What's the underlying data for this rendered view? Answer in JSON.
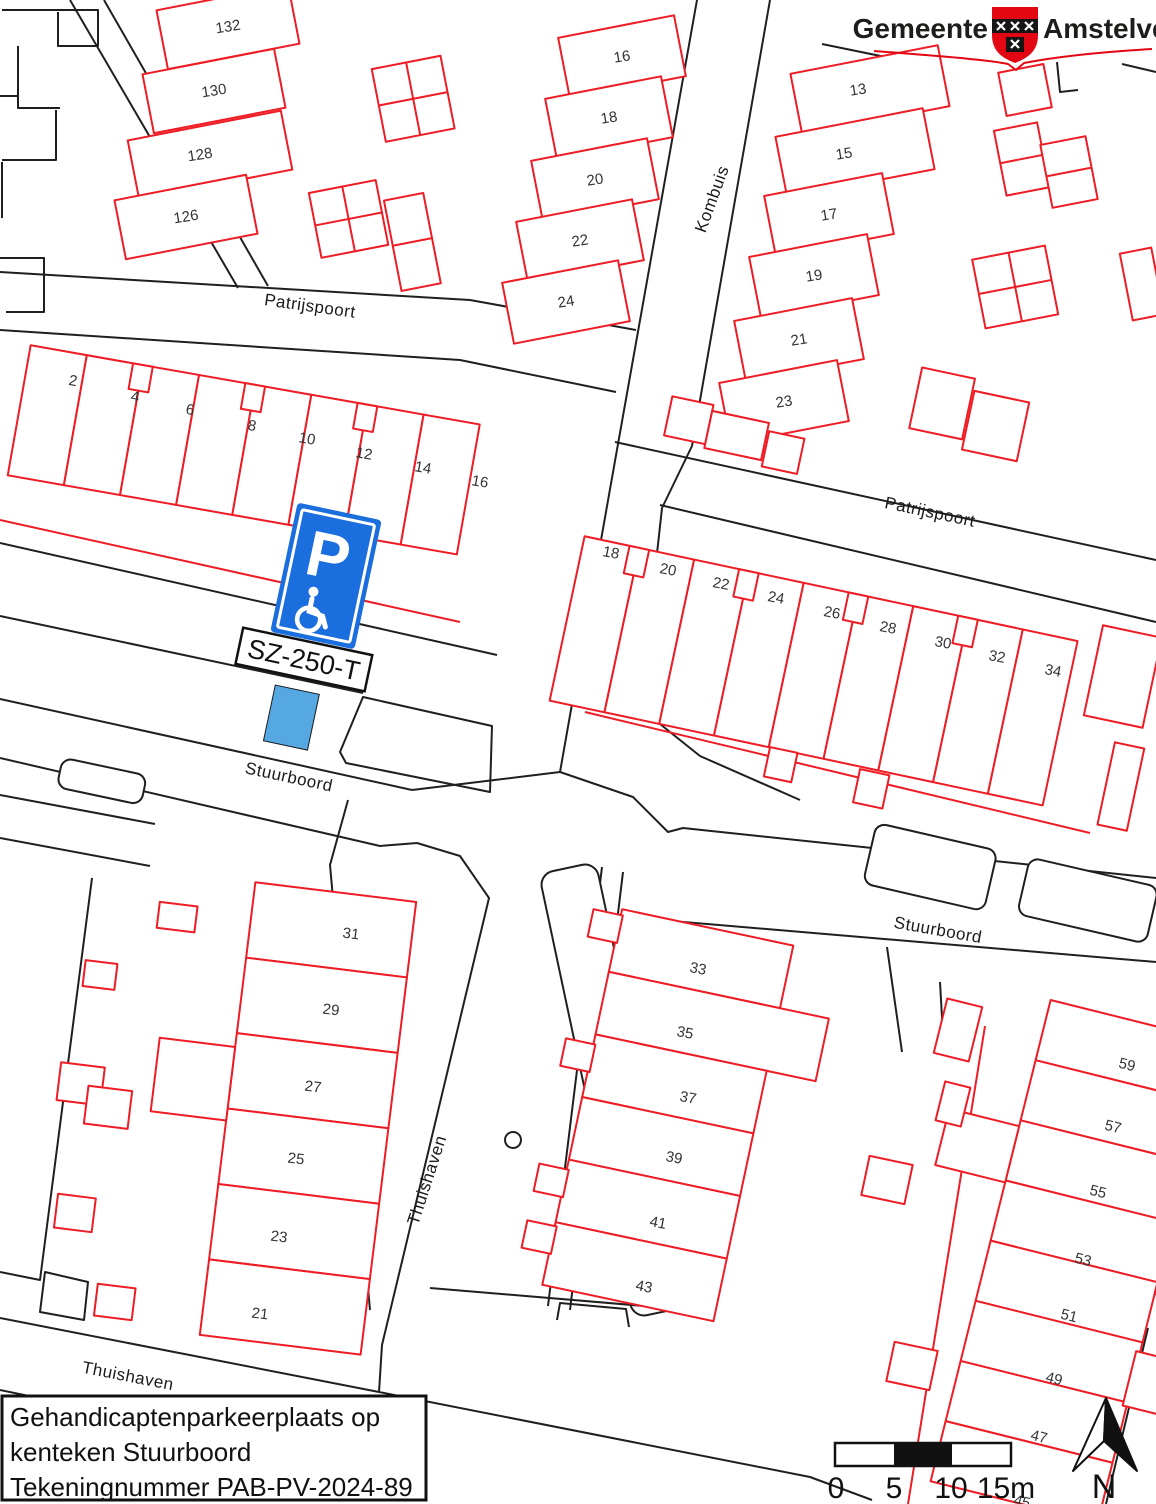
{
  "logo": {
    "part1": "Gemeente",
    "part2": "Amstelveen"
  },
  "title_block": {
    "line1": "Gehandicaptenparkeerplaats op",
    "line2": "kenteken Stuurboord",
    "line3": "Tekeningnummer PAB-PV-2024-89"
  },
  "parking": {
    "sign_letter": "P",
    "license_plate": "SZ-250-T"
  },
  "scale_bar": {
    "labels": [
      "0",
      "5",
      "10",
      "15m"
    ]
  },
  "compass": {
    "label": "N"
  },
  "streets": [
    "Patrijspoort",
    "Kombuis",
    "Patrijspoort",
    "Stuurboord",
    "Stuurboord",
    "Thuishaven",
    "Thuishaven"
  ],
  "house_numbers": [
    "132",
    "130",
    "128",
    "126",
    "16",
    "18",
    "20",
    "22",
    "24",
    "13",
    "15",
    "17",
    "19",
    "21",
    "23",
    "2",
    "4",
    "6",
    "8",
    "10",
    "12",
    "14",
    "16",
    "18",
    "20",
    "22",
    "24",
    "26",
    "28",
    "30",
    "32",
    "34",
    "31",
    "29",
    "27",
    "25",
    "23",
    "21",
    "33",
    "35",
    "37",
    "39",
    "41",
    "43",
    "59",
    "57",
    "55",
    "53",
    "51",
    "49",
    "47",
    "45"
  ],
  "colors": {
    "building_outline": "#ee1c24",
    "parcel_line": "#1f1f1f",
    "sign_blue": "#1b6ede",
    "parking_space_blue": "#56a8e2",
    "logo_red": "#e30613"
  }
}
